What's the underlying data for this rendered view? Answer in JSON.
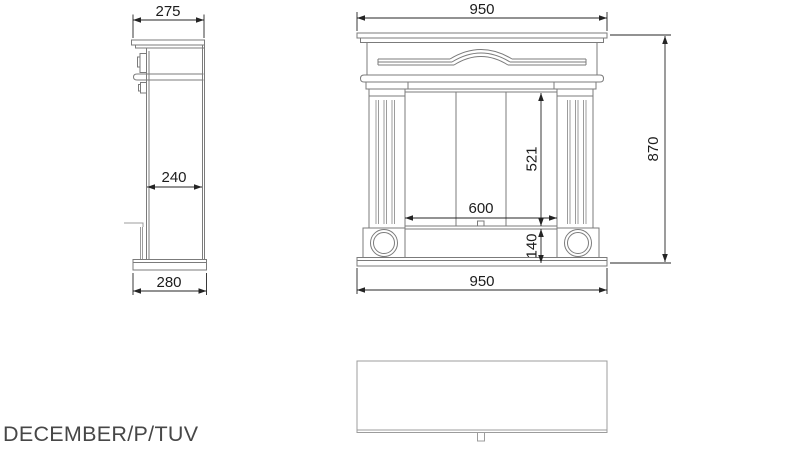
{
  "drawing": {
    "title": "DECEMBER/P/TUV",
    "views": {
      "side": {
        "label": "side-view",
        "dimensions": {
          "shelf_depth": "275",
          "body_depth": "240",
          "base_depth": "280"
        }
      },
      "front": {
        "label": "front-view",
        "dimensions": {
          "shelf_width": "950",
          "opening_width": "600",
          "opening_height": "521",
          "hearth_height": "140",
          "base_width": "950",
          "total_height": "870"
        }
      },
      "plan": {
        "label": "plan-view"
      }
    }
  },
  "colors": {
    "outline": "#7b7b7b",
    "light_line": "#9c9c9c",
    "dimension": "#242424",
    "title_text": "#474747",
    "background": "#ffffff"
  }
}
